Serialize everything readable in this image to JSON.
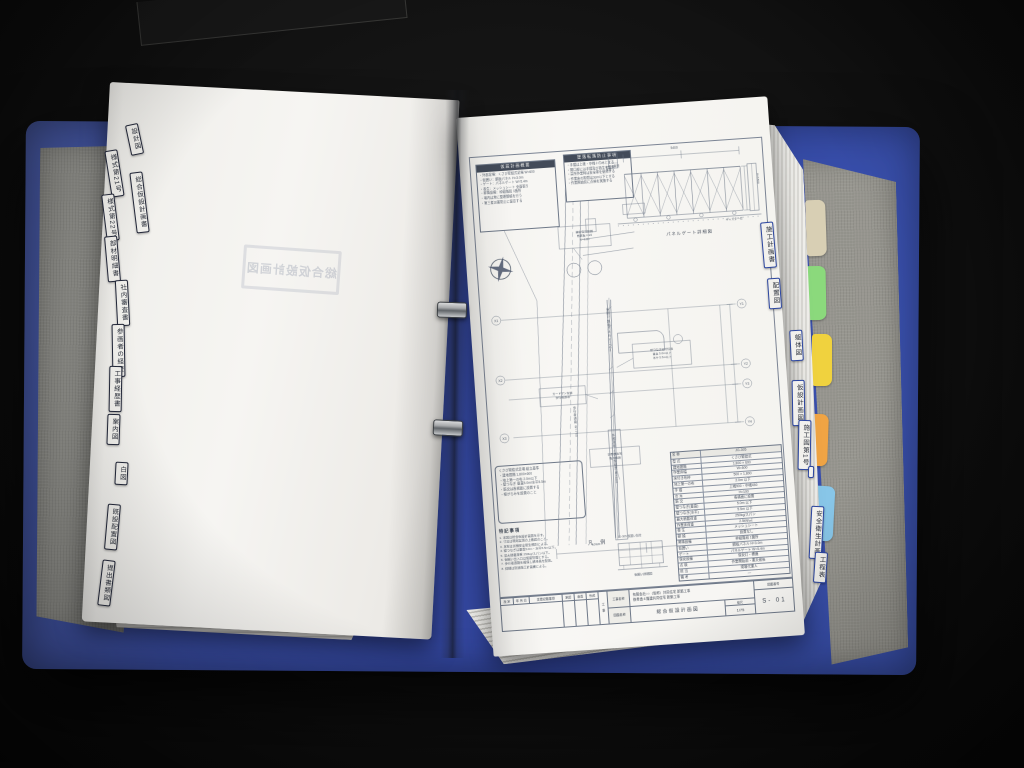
{
  "scene": {
    "background_color": "#0d0d0d",
    "binder_color": "#3a53ad",
    "board_color": "#8f8f8b",
    "description": "Open blue ring binder with construction drawings and index tabs"
  },
  "left_page": {
    "stamp_text": "総合仮設計画図"
  },
  "left_tabs": [
    {
      "label": "設計図"
    },
    {
      "label": "様式第21号"
    },
    {
      "label": "総合仮設計画書"
    },
    {
      "label": "様式第22号"
    },
    {
      "label": "部材明細書"
    },
    {
      "label": "社内審査書"
    },
    {
      "label": "参画者の経歴"
    },
    {
      "label": "工事経歴書"
    },
    {
      "label": "案内図"
    },
    {
      "label": "白図"
    },
    {
      "label": "既設配置図"
    },
    {
      "label": "提出書類図"
    }
  ],
  "right_tabs": [
    {
      "label": "施工計画書"
    },
    {
      "label": "配置図"
    },
    {
      "label": "躯体図"
    },
    {
      "label": "仮設計画図"
    },
    {
      "label": "施工図第1号"
    },
    {
      "label": ""
    },
    {
      "label": "安全衛生計画"
    },
    {
      "label": "工程表"
    }
  ],
  "colored_tabs": [
    {
      "name": "cream-tab",
      "color": "#d8cfb4"
    },
    {
      "name": "green-tab",
      "color": "#8bd97c"
    },
    {
      "name": "yellow-tab",
      "color": "#f0d23e"
    },
    {
      "name": "orange-tab",
      "color": "#f0a444"
    },
    {
      "name": "blue-tab",
      "color": "#88c6e8"
    }
  ],
  "drawing": {
    "notes1": {
      "title": "仮設計画概要",
      "lines": [
        "・外部足場：くさび緊結式足場 W=600",
        "・仮囲い：鋼板パネル H=3.0m",
        "・ゲート：パネルゲート W=5.4m",
        "・養生：メッシュシート 全面張り",
        "・昇降設備：枠組階段 1箇所",
        "・場内は常に整理整頓を行う",
        "・第三者災害防止に留意する"
      ]
    },
    "notes2": {
      "title": "墜落転落防止事項",
      "lines": [
        "・手摺は上桟・中桟＋巾木とする",
        "・開口部には手摺及び養生を設置",
        "・高所作業時は安全帯を使用する",
        "・作業床の隙間は3cm以下とする",
        "・作業開始前に点検を実施する"
      ]
    },
    "gate": {
      "caption": "パネルゲート詳細図",
      "dim_width": "5400",
      "dim_height": "H=1800",
      "label_left": "φ48.6 単管支柱",
      "label_right": "キャスター付",
      "side_label": "控えパイプ"
    },
    "plan": {
      "grid_left": [
        "X1",
        "X2",
        "X3"
      ],
      "grid_right": [
        "Y1",
        "Y2",
        "Y3",
        "Y4"
      ],
      "callout_top": [
        "舗装復旧範囲",
        "敷鉄板 t=22",
        "W=6.0m"
      ],
      "callout_mid": [
        "壁つなぎ取付位置",
        "垂直 5.0m以下",
        "水平 5.5m以下"
      ],
      "callout_road": [
        "ガードマン配置",
        "歩行者誘導"
      ],
      "callout_low": [
        "資機材置場",
        "搬入経路"
      ],
      "vtext1": "仮囲い 鋼板パネル H=3.0m",
      "vtext2": "歩行者通路 W=750",
      "vtext3": "外部足場 くさび緊結式 W=600",
      "dim1": "10920",
      "dim2": "9100"
    },
    "legend_label": "凡 例",
    "detail": {
      "top_label": "JG-305 仮囲い割付",
      "caption": "仮囲い詳細図"
    },
    "wedge_lines": [
      "くさび緊結式足場 組立基準",
      "・建地間隔 1,800×600",
      "・地上第一の布 2.0m以下",
      "・壁つなぎ 垂直5.0m/水平5.5m",
      "・筋交は各構面に設置する",
      "・根がらみを設置のこと"
    ],
    "tokki": {
      "title": "特記事項",
      "lines": [
        "1. 本図は総合仮設計画図を示す。",
        "2. 寸法は現場実測の上確認のこと。",
        "3. 足場は労働安全衛生規則による。",
        "4. 壁つなぎは垂直5.0m・水平5.5m以下。",
        "5. 最大積載荷重 250kg/スパン以下。",
        "6. 仮囲い出入口は施錠管理とする。",
        "7. 歩行者通路を確保し誘導員を配置。",
        "8. 詳細は別途施工計画書による。"
      ]
    },
    "spec_table": {
      "rows": [
        [
          "名 称",
          "JG-305"
        ],
        [
          "型 式",
          "くさび緊結式"
        ],
        [
          "建地間隔",
          "1,800 × 600"
        ],
        [
          "作業床幅",
          "W=600"
        ],
        [
          "床付き布枠",
          "500 × 1,800"
        ],
        [
          "地上第一の布",
          "2.0m 以下"
        ],
        [
          "手 摺",
          "上桟900・中桟450"
        ],
        [
          "巾 木",
          "H=100"
        ],
        [
          "筋 交",
          "各構面に設置"
        ],
        [
          "壁つなぎ(垂直)",
          "5.0m 以下"
        ],
        [
          "壁つなぎ(水平)",
          "5.5m 以下"
        ],
        [
          "最大積載荷重",
          "250kg/スパン"
        ],
        [
          "作業床荷重",
          "2.5kN/㎡"
        ],
        [
          "養 生",
          "メッシュシート"
        ],
        [
          "朝 顔",
          "設置なし"
        ],
        [
          "昇降設備",
          "枠組階段 1箇所"
        ],
        [
          "仮囲い",
          "鋼板パネル H=3.0m"
        ],
        [
          "ゲート",
          "パネルゲート W=5.4m"
        ],
        [
          "保安設備",
          "保安灯・標識"
        ],
        [
          "点 検",
          "作業開始前・悪天候後"
        ],
        [
          "担 当",
          "現場代理人"
        ],
        [
          "備 考",
          "—"
        ]
      ]
    },
    "title_block": {
      "rev_label": "改 定",
      "date_label": "年 月 日",
      "desc_label": "変更記載事項",
      "approve_labels": [
        "承認",
        "審査",
        "作成"
      ],
      "koji_label": "工 事",
      "project_label": "工事名称",
      "project_line1": "有限会社○○（仮称）共同住宅 新築工事",
      "project_line2": "鉄骨造４階建共同住宅 新築工事",
      "sheet_label": "図面名称",
      "sheet_name": "総合仮設計画図",
      "scale_label": "縮尺",
      "scale_value": "1/75",
      "number_label": "図面番号",
      "number_value": "S- 01"
    }
  }
}
